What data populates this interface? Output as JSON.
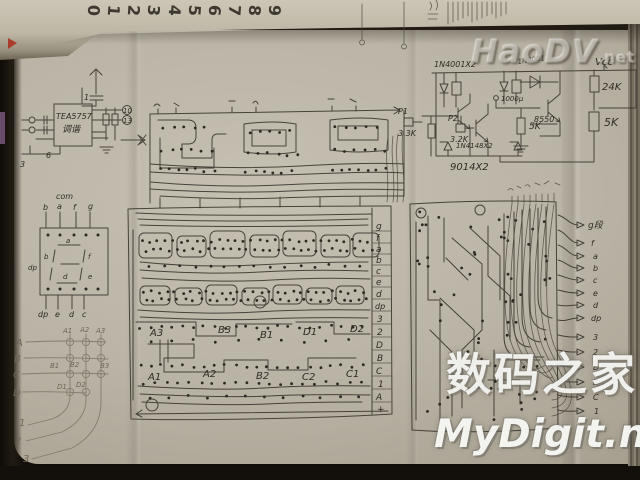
{
  "edge_digits": [
    "0",
    "1",
    "2",
    "3",
    "4",
    "5",
    "6",
    "7",
    "8",
    "9"
  ],
  "watermarks": {
    "embossed": "HaoDV",
    "embossed_tld": ".net",
    "cn": "数码之家",
    "en": "MyDigit.net"
  },
  "tuner": {
    "chip": "TEA5757",
    "sub": "调谐",
    "pin_top": "1",
    "pin_bottom": "6",
    "pin_corner": "3",
    "out1": "10",
    "out2": "13"
  },
  "driver": {
    "vcc": "Vcc",
    "d_top": "1N4001X2",
    "d_mid": "1N4001",
    "r_24k": "24K",
    "r5k_a": "5K",
    "r5k_b": "5K",
    "q_8550": "8550",
    "cap": "1000μ",
    "p1": "P1",
    "p1_r": "3.3K",
    "p2": "P2",
    "p2_r": "3.2K",
    "d_bottom": "1N4148X2",
    "q_pair": "9014X2"
  },
  "display": {
    "com": "com",
    "top_pins": [
      "b",
      "a",
      "f",
      "g"
    ],
    "bottom_pins": [
      "dp",
      "e",
      "d",
      "c"
    ],
    "seg": {
      "a": "a",
      "b": "b",
      "f": "f",
      "d": "d",
      "e": "e",
      "dp": "dp"
    }
  },
  "matrix": {
    "rows": [
      "A",
      "B",
      "C",
      "D"
    ],
    "col_heads": [
      "A1",
      "A2",
      "A3"
    ],
    "mid": [
      "B1",
      "B2",
      "B3"
    ],
    "low": [
      "D1",
      "D2"
    ],
    "nums": [
      "1",
      "2",
      "3"
    ]
  },
  "pcb": {
    "connector": [
      "g",
      "f",
      "a",
      "b",
      "c",
      "e",
      "d",
      "dp",
      "3",
      "2",
      "D",
      "B",
      "C",
      "1",
      "A",
      "+"
    ],
    "parts_top": [
      "A3",
      "B3",
      "B1",
      "D1",
      "D2"
    ],
    "parts_bottom": [
      "A1",
      "A2",
      "B2",
      "C2",
      "C1"
    ]
  },
  "output": {
    "title": "g段",
    "labels": [
      "f",
      "a",
      "b",
      "c",
      "e",
      "d",
      "dp",
      "3",
      "2",
      "D",
      "B",
      "C",
      "1"
    ]
  }
}
